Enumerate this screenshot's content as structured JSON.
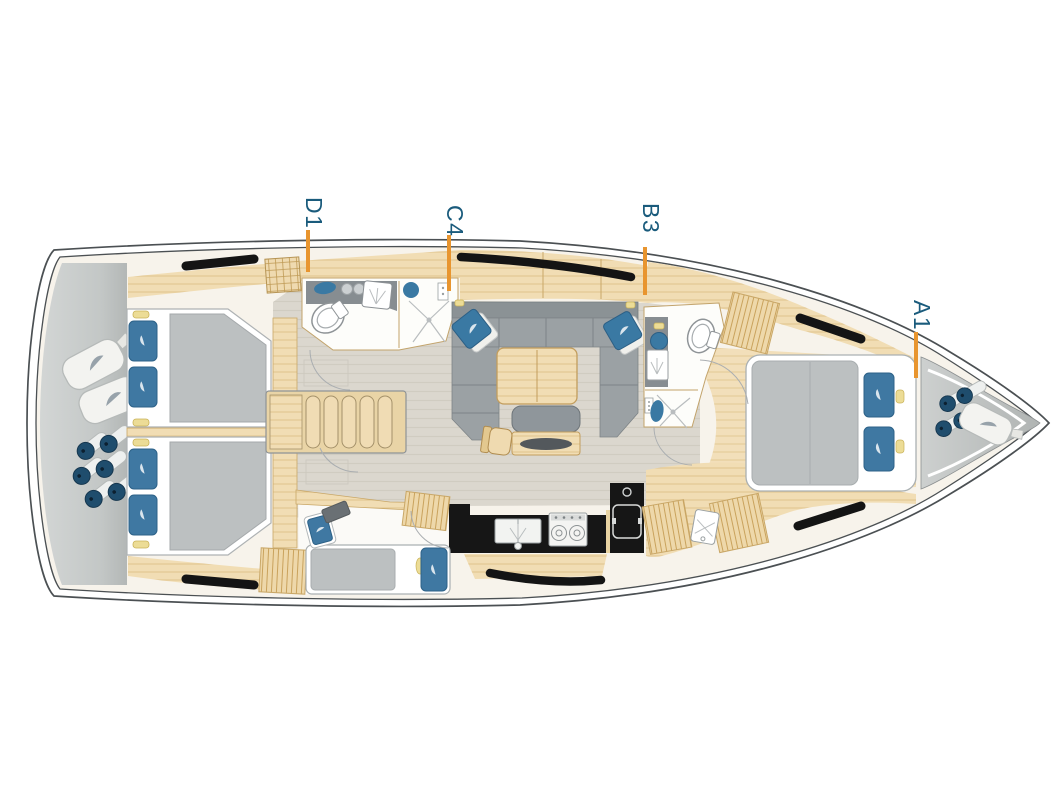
{
  "page": {
    "background": "#ffffff"
  },
  "labels": [
    {
      "text": "D1"
    },
    {
      "text": "C4"
    },
    {
      "text": "B3"
    },
    {
      "text": "A1"
    }
  ],
  "style": {
    "label_color": "#1a5b7c",
    "leader_color": "#e8952f",
    "hull_outline": "#4b5053",
    "deck_cream": "#f7f3eb",
    "wood": "#f1ddb4",
    "floor_gray": "#dbd7ce",
    "upholstery_gray": "#9ba1a4",
    "mattress_gray": "#bcc0c1",
    "cushion_blue": "#3f78a2",
    "counter_black": "#161616",
    "storage_gray": "#c6c9c8",
    "accent_yellow": "#ecdc96"
  },
  "icons": [
    "toilet-icon",
    "sink-icon",
    "shower-drain-icon",
    "stove-icon",
    "fridge-icon",
    "fender-icon",
    "sail-bag-icon",
    "hatch-window-icon",
    "stairs-icon",
    "logo-swoosh-icon",
    "chart-desk-icon"
  ]
}
